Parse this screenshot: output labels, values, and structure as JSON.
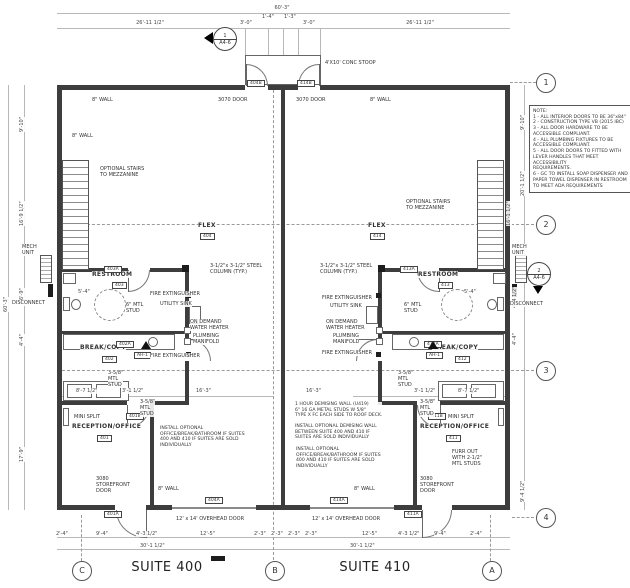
{
  "suites": {
    "left": "SUITE 400",
    "right": "SUITE 410"
  },
  "grid": {
    "right": [
      "1",
      "2",
      "3",
      "4"
    ],
    "bottom": [
      "C",
      "B",
      "A"
    ]
  },
  "markers": [
    {
      "num": "1",
      "sheet": "A4-6"
    },
    {
      "num": "2",
      "sheet": "A4-6"
    }
  ],
  "notes": {
    "text": "NOTE:\n1 - ALL INTERIOR DOORS TO BE 36\"x84\"\n2 - CONSTRUCTION TYPE VB (2015 IBC)\n3 - ALL DOOR HARDWARE TO BE\nACCESSIBLE COMPLIANT.\n4 - ALL PLUMBING FIXTURES TO BE\nACCESSIBLE COMPLIANT.\n5 - ALL DOOR DOORS TO FITTED WITH\nLEVER HANDLES THAT MEET ACCESSIBILITY\nREQUIREMENTS.\n6 - GC TO INSTALL SOAP DISPENSER AND\nPAPER TOWEL DISPENSER IN RESTROOM\nTO MEET ADA REQUIREMENTS"
  },
  "annotations": [
    {
      "n": "dim-top-overall",
      "t": "60'-3\"",
      "x": 262,
      "y": 5,
      "c": 40,
      "cls": "dim"
    },
    {
      "n": "dim-top-left",
      "t": "26'-11 1/2\"",
      "x": 130,
      "y": 20,
      "c": 40,
      "cls": "dim"
    },
    {
      "n": "dim-top-right",
      "t": "26'-11 1/2\"",
      "x": 400,
      "y": 20,
      "c": 40,
      "cls": "dim"
    },
    {
      "n": "dim-stoop-1",
      "t": "3'-0\"",
      "x": 240,
      "y": 20,
      "cls": "dim"
    },
    {
      "n": "dim-stoop-2",
      "t": "1'-4\"",
      "x": 262,
      "y": 14,
      "cls": "dim"
    },
    {
      "n": "dim-stoop-3",
      "t": "1'-3\"",
      "x": 284,
      "y": 14,
      "cls": "dim"
    },
    {
      "n": "dim-stoop-4",
      "t": "3'-0\"",
      "x": 303,
      "y": 20,
      "cls": "dim"
    },
    {
      "n": "dim-left-overall",
      "t": "60'-3\"",
      "x": 3,
      "y": 312,
      "r": 1,
      "cls": "dim"
    },
    {
      "n": "dim-left-1",
      "t": "9'-10\"",
      "x": 19,
      "y": 132,
      "r": 1,
      "cls": "dim"
    },
    {
      "n": "dim-left-2",
      "t": "16'-9 1/2\"",
      "x": 19,
      "y": 226,
      "r": 1,
      "cls": "dim"
    },
    {
      "n": "dim-left-3",
      "t": "6'-9\"",
      "x": 19,
      "y": 300,
      "r": 1,
      "cls": "dim"
    },
    {
      "n": "dim-left-4",
      "t": "4'-4\"",
      "x": 19,
      "y": 346,
      "r": 1,
      "cls": "dim"
    },
    {
      "n": "dim-left-5",
      "t": "17'-9\"",
      "x": 19,
      "y": 462,
      "r": 1,
      "cls": "dim"
    },
    {
      "n": "dim-right-1",
      "t": "9'-10\"",
      "x": 520,
      "y": 130,
      "r": 1,
      "cls": "dim"
    },
    {
      "n": "dim-right-2",
      "t": "20'-1 1/2\"",
      "x": 520,
      "y": 196,
      "r": 1,
      "cls": "dim"
    },
    {
      "n": "dim-right-3",
      "t": "16'-1 1/2\"",
      "x": 506,
      "y": 226,
      "r": 1,
      "cls": "dim"
    },
    {
      "n": "dim-right-4",
      "t": "4'-4 1/2\"",
      "x": 512,
      "y": 308,
      "r": 1,
      "cls": "dim"
    },
    {
      "n": "dim-right-5",
      "t": "4'-4\"",
      "x": 512,
      "y": 345,
      "r": 1,
      "cls": "dim"
    },
    {
      "n": "dim-right-6",
      "t": "9'-4 1/2\"",
      "x": 520,
      "y": 502,
      "r": 1,
      "cls": "dim"
    },
    {
      "n": "dim-bot-1",
      "t": "2'-4\"",
      "x": 56,
      "y": 531,
      "cls": "dim"
    },
    {
      "n": "dim-bot-2",
      "t": "9'-4\"",
      "x": 96,
      "y": 531,
      "cls": "dim"
    },
    {
      "n": "dim-bot-3",
      "t": "4'-3 1/2\"",
      "x": 136,
      "y": 531,
      "cls": "dim"
    },
    {
      "n": "dim-bot-4",
      "t": "12'-5\"",
      "x": 200,
      "y": 531,
      "cls": "dim"
    },
    {
      "n": "dim-bot-5",
      "t": "2'-3\"",
      "x": 254,
      "y": 531,
      "cls": "dim"
    },
    {
      "n": "dim-bot-6",
      "t": "2'-3\"",
      "x": 271,
      "y": 531,
      "cls": "dim"
    },
    {
      "n": "dim-bot-7",
      "t": "2'-3\"",
      "x": 288,
      "y": 531,
      "cls": "dim"
    },
    {
      "n": "dim-bot-8",
      "t": "2'-3\"",
      "x": 305,
      "y": 531,
      "cls": "dim"
    },
    {
      "n": "dim-bot-9",
      "t": "12'-5\"",
      "x": 362,
      "y": 531,
      "cls": "dim"
    },
    {
      "n": "dim-bot-10",
      "t": "4'-3 1/2\"",
      "x": 398,
      "y": 531,
      "cls": "dim"
    },
    {
      "n": "dim-bot-11",
      "t": "9'-4\"",
      "x": 434,
      "y": 531,
      "cls": "dim"
    },
    {
      "n": "dim-bot-12",
      "t": "2'-4\"",
      "x": 470,
      "y": 531,
      "cls": "dim"
    },
    {
      "n": "dim-bot-30-left",
      "t": "30'-1 1/2\"",
      "x": 140,
      "y": 543,
      "cls": "dim"
    },
    {
      "n": "dim-bot-30-right",
      "t": "30'-1 1/2\"",
      "x": 350,
      "y": 543,
      "cls": "dim"
    },
    {
      "n": "dim-int-1",
      "t": "8'-7 1/2\"",
      "x": 76,
      "y": 388,
      "cls": "dim"
    },
    {
      "n": "dim-int-2",
      "t": "3'-1 1/2\"",
      "x": 122,
      "y": 388,
      "cls": "dim"
    },
    {
      "n": "dim-int-3",
      "t": "16'-3\"",
      "x": 196,
      "y": 388,
      "cls": "dim"
    },
    {
      "n": "dim-int-4",
      "t": "16'-3\"",
      "x": 306,
      "y": 388,
      "cls": "dim"
    },
    {
      "n": "dim-int-5",
      "t": "3'-1 1/2\"",
      "x": 414,
      "y": 388,
      "cls": "dim"
    },
    {
      "n": "dim-int-6",
      "t": "8'-7 1/2\"",
      "x": 458,
      "y": 388,
      "cls": "dim"
    },
    {
      "n": "dim-ada-left",
      "t": "5'-4\"",
      "x": 78,
      "y": 289,
      "cls": "dim"
    },
    {
      "n": "dim-ada-right",
      "t": "5'-4\"",
      "x": 464,
      "y": 289,
      "cls": "dim"
    },
    {
      "n": "room-flex-400",
      "t": "FLEX",
      "x": 198,
      "y": 222,
      "cls": "room"
    },
    {
      "n": "tag-room-404",
      "t": "404",
      "x": 200,
      "y": 233,
      "cls": "tag"
    },
    {
      "n": "room-flex-410",
      "t": "FLEX",
      "x": 368,
      "y": 222,
      "cls": "room"
    },
    {
      "n": "tag-room-414",
      "t": "414",
      "x": 370,
      "y": 233,
      "cls": "tag"
    },
    {
      "n": "room-restroom-400",
      "t": "RESTROOM",
      "x": 92,
      "y": 271,
      "cls": "room"
    },
    {
      "n": "tag-room-403",
      "t": "403",
      "x": 112,
      "y": 282,
      "cls": "tag"
    },
    {
      "n": "room-restroom-410",
      "t": "RESTROOM",
      "x": 418,
      "y": 271,
      "cls": "room"
    },
    {
      "n": "tag-room-413",
      "t": "413",
      "x": 438,
      "y": 282,
      "cls": "tag"
    },
    {
      "n": "room-break-400",
      "t": "BREAK/COPY",
      "x": 80,
      "y": 344,
      "cls": "room"
    },
    {
      "n": "tag-room-402",
      "t": "402",
      "x": 102,
      "y": 356,
      "cls": "tag"
    },
    {
      "n": "room-break-410",
      "t": "BREAK/COPY",
      "x": 432,
      "y": 344,
      "cls": "room"
    },
    {
      "n": "tag-room-412",
      "t": "412",
      "x": 455,
      "y": 356,
      "cls": "tag"
    },
    {
      "n": "room-reception-400",
      "t": "RECEPTION/OFFICE",
      "x": 72,
      "y": 423,
      "cls": "room"
    },
    {
      "n": "tag-room-401",
      "t": "401",
      "x": 97,
      "y": 435,
      "cls": "tag"
    },
    {
      "n": "room-reception-410",
      "t": "RECEPTION/OFFICE",
      "x": 420,
      "y": 423,
      "cls": "room"
    },
    {
      "n": "tag-room-411",
      "t": "411",
      "x": 446,
      "y": 435,
      "cls": "tag"
    },
    {
      "n": "tag-door-404b",
      "t": "404B",
      "x": 247,
      "y": 80,
      "cls": "tag"
    },
    {
      "n": "tag-door-414b",
      "t": "414B",
      "x": 297,
      "y": 80,
      "cls": "tag"
    },
    {
      "n": "tag-door-403a",
      "t": "403A",
      "x": 104,
      "y": 266,
      "cls": "tag"
    },
    {
      "n": "tag-door-413a",
      "t": "413A",
      "x": 400,
      "y": 266,
      "cls": "tag"
    },
    {
      "n": "tag-door-402a",
      "t": "402A",
      "x": 116,
      "y": 341,
      "cls": "tag"
    },
    {
      "n": "tag-door-412a",
      "t": "412A",
      "x": 424,
      "y": 341,
      "cls": "tag"
    },
    {
      "n": "tag-door-401b",
      "t": "401B",
      "x": 126,
      "y": 413,
      "cls": "tag"
    },
    {
      "n": "tag-door-411b",
      "t": "411B",
      "x": 428,
      "y": 413,
      "cls": "tag"
    },
    {
      "n": "tag-door-401a",
      "t": "401A",
      "x": 104,
      "y": 511,
      "cls": "tag"
    },
    {
      "n": "tag-door-411a",
      "t": "411A",
      "x": 404,
      "y": 511,
      "cls": "tag"
    },
    {
      "n": "tag-door-404a",
      "t": "404A",
      "x": 205,
      "y": 497,
      "cls": "tag"
    },
    {
      "n": "tag-door-414a",
      "t": "414A",
      "x": 330,
      "y": 497,
      "cls": "tag"
    },
    {
      "n": "tag-ah1-left",
      "t": "AH-1",
      "x": 134,
      "y": 352,
      "cls": "tag"
    },
    {
      "n": "tag-ah1-right",
      "t": "AH-1",
      "x": 426,
      "y": 352,
      "cls": "tag"
    },
    {
      "n": "label-mech-unit-left",
      "t": "MECH\nUNIT",
      "x": 22,
      "y": 244
    },
    {
      "n": "label-mech-unit-right",
      "t": "MECH\nUNIT",
      "x": 512,
      "y": 244
    },
    {
      "n": "label-disconnect-left",
      "t": "DISCONNECT",
      "x": 12,
      "y": 300
    },
    {
      "n": "label-disconnect-right",
      "t": "DISCONNECT",
      "x": 510,
      "y": 301
    },
    {
      "n": "label-stairs-left",
      "t": "OPTIONAL STAIRS\nTO MEZZANINE",
      "x": 100,
      "y": 166
    },
    {
      "n": "label-stairs-right",
      "t": "OPTIONAL STAIRS\nTO MEZZANINE",
      "x": 406,
      "y": 199
    },
    {
      "n": "label-mini-split-left",
      "t": "MINI SPLIT",
      "x": 74,
      "y": 414
    },
    {
      "n": "label-mini-split-right",
      "t": "MINI SPLIT",
      "x": 448,
      "y": 414
    },
    {
      "n": "label-8wall-top-left",
      "t": "8\" WALL",
      "x": 92,
      "y": 97
    },
    {
      "n": "label-3070-left",
      "t": "3070 DOOR",
      "x": 218,
      "y": 97
    },
    {
      "n": "label-3070-right",
      "t": "3070 DOOR",
      "x": 296,
      "y": 97
    },
    {
      "n": "label-8wall-top-right",
      "t": "8\" WALL",
      "x": 370,
      "y": 97
    },
    {
      "n": "label-8wall-left",
      "t": "8\" WALL",
      "x": 72,
      "y": 133
    },
    {
      "n": "label-8wall-bot-left",
      "t": "8\" WALL",
      "x": 158,
      "y": 486
    },
    {
      "n": "label-8wall-bot-right",
      "t": "8\" WALL",
      "x": 354,
      "y": 486
    },
    {
      "n": "label-stoop",
      "t": "4'X10' CONC STOOP",
      "x": 325,
      "y": 60
    },
    {
      "n": "label-oh-door-left",
      "t": "12' x 14' OVERHEAD DOOR",
      "x": 176,
      "y": 516
    },
    {
      "n": "label-oh-door-right",
      "t": "12' x 14' OVERHEAD DOOR",
      "x": 312,
      "y": 516
    },
    {
      "n": "label-storefront-left",
      "t": "3080\nSTOREFRONT\nDOOR",
      "x": 96,
      "y": 476
    },
    {
      "n": "label-storefront-right",
      "t": "3080\nSTOREFRONT\nDOOR",
      "x": 420,
      "y": 476
    },
    {
      "n": "label-column-left",
      "t": "3-1/2\"x 3-1/2\" STEEL\nCOLUMN (TYP.)",
      "x": 210,
      "y": 263
    },
    {
      "n": "label-column-right",
      "t": "3-1/2\"x 3-1/2\" STEEL\nCOLUMN (TYP.)",
      "x": 320,
      "y": 263
    },
    {
      "n": "label-fire-ext-left-1",
      "t": "FIRE EXTINGUISHER",
      "x": 150,
      "y": 291
    },
    {
      "n": "label-utility-sink-left",
      "t": "UTILITY SINK",
      "x": 160,
      "y": 301
    },
    {
      "n": "label-water-heater-left",
      "t": "ON DEMAND\nWATER HEATER",
      "x": 190,
      "y": 319
    },
    {
      "n": "label-manifold-left",
      "t": "PLUMBING\nMANIFOLD",
      "x": 193,
      "y": 333
    },
    {
      "n": "label-fire-ext-left-2",
      "t": "FIRE EXTINGUISHER",
      "x": 150,
      "y": 353
    },
    {
      "n": "label-fire-ext-right-1",
      "t": "FIRE EXTINGUISHER",
      "x": 322,
      "y": 295
    },
    {
      "n": "label-utility-sink-right",
      "t": "UTILITY SINK",
      "x": 330,
      "y": 303
    },
    {
      "n": "label-water-heater-right",
      "t": "ON DEMAND\nWATER HEATER",
      "x": 326,
      "y": 319
    },
    {
      "n": "label-manifold-right",
      "t": "PLUMBING\nMANIFOLD",
      "x": 333,
      "y": 333
    },
    {
      "n": "label-fire-ext-right-2",
      "t": "FIRE EXTINGUISHER",
      "x": 322,
      "y": 350
    },
    {
      "n": "label-6mtl-left",
      "t": "6\" MTL\nSTUD",
      "x": 126,
      "y": 302
    },
    {
      "n": "label-6mtl-right",
      "t": "6\" MTL\nSTUD",
      "x": 404,
      "y": 302
    },
    {
      "n": "label-358mtl-left",
      "t": "3-5/8\"\nMTL\nSTUD",
      "x": 108,
      "y": 370
    },
    {
      "n": "label-358mtl-right",
      "t": "3-5/8\"\nMTL\nSTUD",
      "x": 398,
      "y": 370
    },
    {
      "n": "label-358mtl-left-2",
      "t": "3-5/8\"\nMTL\nSTUD",
      "x": 140,
      "y": 399
    },
    {
      "n": "label-358mtl-right-2",
      "t": "3-5/8\"\nMTL\nSTUD",
      "x": 420,
      "y": 399
    },
    {
      "n": "label-furr-out",
      "t": "FURR OUT\nWITH 2-1/2\"\nMTL STUDS",
      "x": 452,
      "y": 449
    },
    {
      "n": "note-demising-wall",
      "t": "1 HOUR DEMISING WALL (U419)\n6\" 16 GA METAL STUDS W 5/8\"\nTYPE X FC EACH SIDE TO ROOF DECK.",
      "x": 295,
      "y": 402,
      "cls": "note"
    },
    {
      "n": "note-optional-demising",
      "t": "INSTALL OPTIONAL DEMISING WALL\nBETWEEN SUITE 400 AND 410 IF\nSUITES ARE SOLD INDIVIDUALLY",
      "x": 295,
      "y": 424,
      "cls": "note"
    },
    {
      "n": "note-optional-office-right",
      "t": "INSTALL OPTIONAL\nOFFICE/BREAK/BATHROOM IF SUITES\n400 AND 410 IF SUITES ARE SOLD\nINDIVIDUALLY",
      "x": 296,
      "y": 447,
      "cls": "note"
    },
    {
      "n": "note-optional-office-left",
      "t": "INSTALL OPTIONAL\nOFFICE/BREAK/BATHROOM IF SUITES\n400 AND 410 IF SUITES ARE SOLD\nINDIVIDUALLY",
      "x": 160,
      "y": 426,
      "cls": "note"
    }
  ]
}
